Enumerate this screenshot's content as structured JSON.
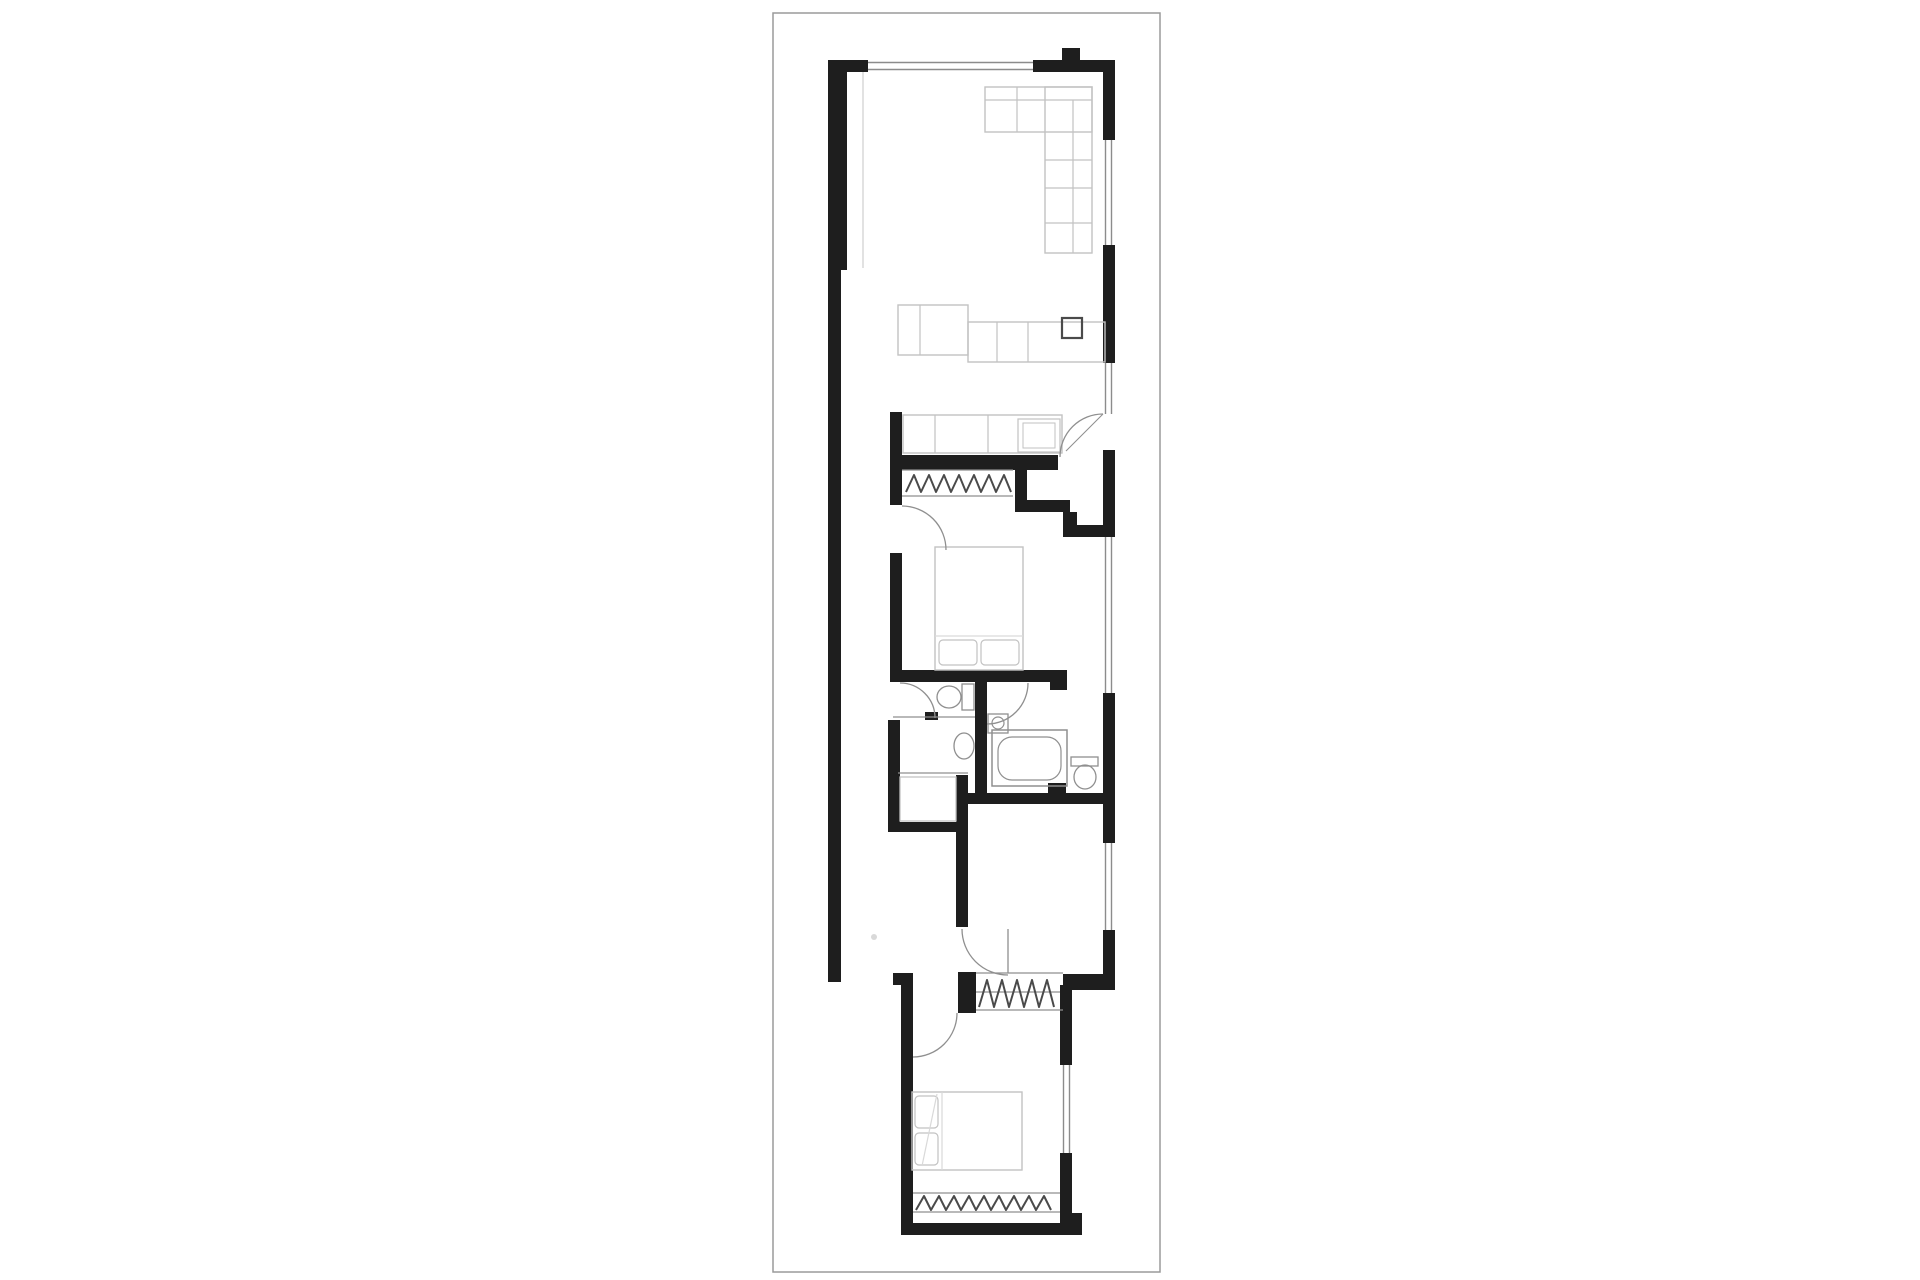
{
  "document": {
    "type": "architectural-floor-plan",
    "description": "Long narrow single-storey dwelling floor plan, black walls on white"
  },
  "canvas": {
    "width": 1920,
    "height": 1280,
    "background": "#ffffff"
  },
  "palette": {
    "wall": "#1e1e1e",
    "border": "#9a9a9a",
    "window": "#8c8c8c",
    "furniture": "#c2c2c2",
    "fixture": "#8f8f8f",
    "glyph": "#4a4a4a",
    "faint": "#d9d9d9"
  },
  "sheet_border": {
    "x": 773,
    "y": 13,
    "w": 387,
    "h": 1259
  },
  "elements": [
    {
      "n": "left-wall-upper",
      "t": "r",
      "x": 828,
      "y": 60,
      "w": 19,
      "h": 210,
      "f": "wall"
    },
    {
      "n": "left-wall-lower",
      "t": "r",
      "x": 828,
      "y": 268,
      "w": 13,
      "h": 714,
      "f": "wall"
    },
    {
      "n": "top-wall-left-stub",
      "t": "r",
      "x": 828,
      "y": 60,
      "w": 40,
      "h": 12,
      "f": "wall"
    },
    {
      "n": "top-wall-right",
      "t": "r",
      "x": 1033,
      "y": 60,
      "w": 82,
      "h": 12,
      "f": "wall"
    },
    {
      "n": "top-flue-stub",
      "t": "r",
      "x": 1062,
      "y": 48,
      "w": 18,
      "h": 13,
      "f": "wall"
    },
    {
      "n": "right-wall-seg1",
      "t": "r",
      "x": 1103,
      "y": 60,
      "w": 12,
      "h": 80,
      "f": "wall"
    },
    {
      "n": "right-wall-seg2",
      "t": "r",
      "x": 1103,
      "y": 245,
      "w": 12,
      "h": 118,
      "f": "wall"
    },
    {
      "n": "right-wall-seg3",
      "t": "r",
      "x": 1103,
      "y": 450,
      "w": 12,
      "h": 87,
      "f": "wall"
    },
    {
      "n": "right-wall-seg4",
      "t": "r",
      "x": 1103,
      "y": 693,
      "w": 12,
      "h": 150,
      "f": "wall"
    },
    {
      "n": "right-wall-seg5",
      "t": "r",
      "x": 1103,
      "y": 930,
      "w": 12,
      "h": 60,
      "f": "wall"
    },
    {
      "n": "laundry-left-wall",
      "t": "r",
      "x": 890,
      "y": 412,
      "w": 12,
      "h": 93,
      "f": "wall"
    },
    {
      "n": "bed1-left-wall",
      "t": "r",
      "x": 890,
      "y": 553,
      "w": 12,
      "h": 120,
      "f": "wall"
    },
    {
      "n": "laundry-bed1-wall",
      "t": "r",
      "x": 890,
      "y": 455,
      "w": 168,
      "h": 15,
      "f": "wall"
    },
    {
      "n": "vestibule-step-v1",
      "t": "r",
      "x": 1015,
      "y": 470,
      "w": 12,
      "h": 42,
      "f": "wall"
    },
    {
      "n": "vestibule-step-h1",
      "t": "r",
      "x": 1015,
      "y": 500,
      "w": 55,
      "h": 12,
      "f": "wall"
    },
    {
      "n": "vestibule-step-v2",
      "t": "r",
      "x": 1063,
      "y": 512,
      "w": 14,
      "h": 25,
      "f": "wall"
    },
    {
      "n": "vestibule-step-h2",
      "t": "r",
      "x": 1070,
      "y": 525,
      "w": 45,
      "h": 12,
      "f": "wall"
    },
    {
      "n": "bed1-bottom-wall",
      "t": "r",
      "x": 890,
      "y": 670,
      "w": 177,
      "h": 12,
      "f": "wall"
    },
    {
      "n": "bed1-bottom-stub",
      "t": "r",
      "x": 1050,
      "y": 682,
      "w": 17,
      "h": 8,
      "f": "wall"
    },
    {
      "n": "bath-center-wall",
      "t": "r",
      "x": 975,
      "y": 680,
      "w": 12,
      "h": 115,
      "f": "wall"
    },
    {
      "n": "wc-pier",
      "t": "r",
      "x": 925,
      "y": 712,
      "w": 13,
      "h": 8,
      "f": "wall"
    },
    {
      "n": "bath-left-wall",
      "t": "r",
      "x": 888,
      "y": 720,
      "w": 12,
      "h": 112,
      "f": "wall"
    },
    {
      "n": "store-bottom-wall",
      "t": "r",
      "x": 888,
      "y": 822,
      "w": 70,
      "h": 10,
      "f": "wall"
    },
    {
      "n": "rear-divider-wall",
      "t": "r",
      "x": 956,
      "y": 775,
      "w": 12,
      "h": 152,
      "f": "wall"
    },
    {
      "n": "bath-bottom-wall",
      "t": "r",
      "x": 958,
      "y": 793,
      "w": 152,
      "h": 11,
      "f": "wall"
    },
    {
      "n": "bath-bottom-pier",
      "t": "r",
      "x": 1048,
      "y": 783,
      "w": 18,
      "h": 10,
      "f": "wall"
    },
    {
      "n": "rear-robe-left-pier",
      "t": "r",
      "x": 958,
      "y": 972,
      "w": 18,
      "h": 41,
      "f": "wall"
    },
    {
      "n": "rear-right-bar",
      "t": "r",
      "x": 1063,
      "y": 974,
      "w": 52,
      "h": 16,
      "f": "wall"
    },
    {
      "n": "rear-bed-right-wall-top",
      "t": "r",
      "x": 1060,
      "y": 985,
      "w": 12,
      "h": 80,
      "f": "wall"
    },
    {
      "n": "rear-bed-right-wall-bottom",
      "t": "r",
      "x": 1060,
      "y": 1153,
      "w": 12,
      "h": 72,
      "f": "wall"
    },
    {
      "n": "rear-bed-bottom-wall",
      "t": "r",
      "x": 901,
      "y": 1223,
      "w": 181,
      "h": 12,
      "f": "wall"
    },
    {
      "n": "rear-bed-bottom-corner",
      "t": "r",
      "x": 1060,
      "y": 1213,
      "w": 22,
      "h": 12,
      "f": "wall"
    },
    {
      "n": "rear-bed-left-wall",
      "t": "r",
      "x": 901,
      "y": 985,
      "w": 12,
      "h": 250,
      "f": "wall"
    },
    {
      "n": "rear-bed-left-stub",
      "t": "r",
      "x": 893,
      "y": 973,
      "w": 20,
      "h": 12,
      "f": "wall"
    },
    {
      "n": "top-window-line1",
      "t": "l",
      "x1": 868,
      "y1": 62.5,
      "x2": 1033,
      "y2": 62.5,
      "s": "window",
      "sw": 1.4
    },
    {
      "n": "top-window-line2",
      "t": "l",
      "x1": 868,
      "y1": 69.5,
      "x2": 1033,
      "y2": 69.5,
      "s": "window",
      "sw": 1.4
    },
    {
      "n": "right-window1-line1",
      "t": "l",
      "x1": 1105.5,
      "y1": 140,
      "x2": 1105.5,
      "y2": 245,
      "s": "window",
      "sw": 1.4
    },
    {
      "n": "right-window1-line2",
      "t": "l",
      "x1": 1111.5,
      "y1": 140,
      "x2": 1111.5,
      "y2": 245,
      "s": "window",
      "sw": 1.4
    },
    {
      "n": "entry-sidelite-line1",
      "t": "l",
      "x1": 1105.5,
      "y1": 363,
      "x2": 1105.5,
      "y2": 414,
      "s": "window",
      "sw": 1.4
    },
    {
      "n": "entry-sidelite-line2",
      "t": "l",
      "x1": 1111.5,
      "y1": 363,
      "x2": 1111.5,
      "y2": 414,
      "s": "window",
      "sw": 1.4
    },
    {
      "n": "right-window2-line1",
      "t": "l",
      "x1": 1105.5,
      "y1": 537,
      "x2": 1105.5,
      "y2": 693,
      "s": "window",
      "sw": 1.4
    },
    {
      "n": "right-window2-line2",
      "t": "l",
      "x1": 1111.5,
      "y1": 537,
      "x2": 1111.5,
      "y2": 693,
      "s": "window",
      "sw": 1.4
    },
    {
      "n": "right-window3-line1",
      "t": "l",
      "x1": 1105.5,
      "y1": 843,
      "x2": 1105.5,
      "y2": 930,
      "s": "window",
      "sw": 1.4
    },
    {
      "n": "right-window3-line2",
      "t": "l",
      "x1": 1111.5,
      "y1": 843,
      "x2": 1111.5,
      "y2": 930,
      "s": "window",
      "sw": 1.4
    },
    {
      "n": "rear-window-line1",
      "t": "l",
      "x1": 1063.5,
      "y1": 1065,
      "x2": 1063.5,
      "y2": 1153,
      "s": "window",
      "sw": 1.4
    },
    {
      "n": "rear-window-line2",
      "t": "l",
      "x1": 1069.5,
      "y1": 1065,
      "x2": 1069.5,
      "y2": 1153,
      "s": "window",
      "sw": 1.4
    },
    {
      "n": "party-wall-face-line",
      "t": "l",
      "x1": 863,
      "y1": 72,
      "x2": 863,
      "y2": 268,
      "s": "faint",
      "sw": 1.5
    },
    {
      "n": "wc-divider-line",
      "t": "l",
      "x1": 893,
      "y1": 717,
      "x2": 975,
      "y2": 717,
      "s": "fixture",
      "sw": 1.2
    },
    {
      "n": "store-divider-line",
      "t": "l",
      "x1": 898,
      "y1": 773,
      "x2": 968,
      "y2": 773,
      "s": "fixture",
      "sw": 1.2
    },
    {
      "n": "ceiling-mark-dot",
      "t": "c",
      "cx": 874,
      "cy": 937,
      "r": 3,
      "f": "faint"
    },
    {
      "n": "sofa-top-arm",
      "t": "r",
      "x": 985,
      "y": 87,
      "w": 107,
      "h": 45,
      "s": "furniture",
      "sw": 1.4
    },
    {
      "n": "sofa-side-arm",
      "t": "r",
      "x": 1045,
      "y": 87,
      "w": 47,
      "h": 166,
      "s": "furniture",
      "sw": 1.4
    },
    {
      "n": "sofa-back-line",
      "t": "l",
      "x1": 985,
      "y1": 100,
      "x2": 1092,
      "y2": 100,
      "s": "furniture",
      "sw": 1.2
    },
    {
      "n": "sofa-seat-div",
      "t": "l",
      "x1": 1017,
      "y1": 87,
      "x2": 1017,
      "y2": 132,
      "s": "furniture",
      "sw": 1.2
    },
    {
      "n": "sofa-inner-line",
      "t": "l",
      "x1": 1073,
      "y1": 100,
      "x2": 1073,
      "y2": 253,
      "s": "furniture",
      "sw": 1.2
    },
    {
      "n": "sofa-cushion-div1",
      "t": "l",
      "x1": 1045,
      "y1": 160,
      "x2": 1092,
      "y2": 160,
      "s": "furniture",
      "sw": 1.2
    },
    {
      "n": "sofa-cushion-div2",
      "t": "l",
      "x1": 1045,
      "y1": 188,
      "x2": 1092,
      "y2": 188,
      "s": "furniture",
      "sw": 1.2
    },
    {
      "n": "sofa-cushion-div3",
      "t": "l",
      "x1": 1045,
      "y1": 223,
      "x2": 1092,
      "y2": 223,
      "s": "furniture",
      "sw": 1.2
    },
    {
      "n": "kitchen-island",
      "t": "r",
      "x": 898,
      "y": 305,
      "w": 70,
      "h": 50,
      "s": "furniture",
      "sw": 1.4
    },
    {
      "n": "kitchen-island-div",
      "t": "l",
      "x1": 920,
      "y1": 305,
      "x2": 920,
      "y2": 355,
      "s": "furniture",
      "sw": 1.2
    },
    {
      "n": "kitchen-counter",
      "t": "r",
      "x": 968,
      "y": 322,
      "w": 137,
      "h": 40,
      "s": "furniture",
      "sw": 1.4
    },
    {
      "n": "kitchen-counter-div1",
      "t": "l",
      "x1": 997,
      "y1": 322,
      "x2": 997,
      "y2": 362,
      "s": "furniture",
      "sw": 1.2
    },
    {
      "n": "kitchen-counter-div2",
      "t": "l",
      "x1": 1028,
      "y1": 322,
      "x2": 1028,
      "y2": 362,
      "s": "furniture",
      "sw": 1.2
    },
    {
      "n": "kitchen-sink",
      "t": "r",
      "x": 1062,
      "y": 318,
      "w": 20,
      "h": 20,
      "s": "glyph",
      "sw": 2.2
    },
    {
      "n": "laundry-bench",
      "t": "r",
      "x": 903,
      "y": 415,
      "w": 159,
      "h": 38,
      "s": "furniture",
      "sw": 1.4
    },
    {
      "n": "laundry-bench-div1",
      "t": "l",
      "x1": 935,
      "y1": 415,
      "x2": 935,
      "y2": 453,
      "s": "furniture",
      "sw": 1.2
    },
    {
      "n": "laundry-bench-div2",
      "t": "l",
      "x1": 988,
      "y1": 415,
      "x2": 988,
      "y2": 453,
      "s": "furniture",
      "sw": 1.2
    },
    {
      "n": "washing-machine",
      "t": "r",
      "x": 1018,
      "y": 419,
      "w": 42,
      "h": 33,
      "s": "furniture",
      "sw": 1.2
    },
    {
      "n": "washing-machine-inner",
      "t": "r",
      "x": 1023,
      "y": 423,
      "w": 32,
      "h": 25,
      "s": "furniture",
      "sw": 1
    },
    {
      "n": "robe1-top-line",
      "t": "l",
      "x1": 902,
      "y1": 470,
      "x2": 1013,
      "y2": 470,
      "s": "fixture",
      "sw": 1.2
    },
    {
      "n": "robe1-bottom-line",
      "t": "l",
      "x1": 902,
      "y1": 496,
      "x2": 1013,
      "y2": 496,
      "s": "fixture",
      "sw": 1.2
    },
    {
      "n": "robe1-zigzag",
      "t": "p",
      "d": "M906 492 L914 475 L921 492 L929 475 L936 492 L944 475 L951 492 L959 475 L966 492 L974 475 L981 492 L989 475 L996 492 L1004 475 L1011 492",
      "s": "glyph",
      "sw": 2
    },
    {
      "n": "bed1",
      "t": "r",
      "x": 935,
      "y": 547,
      "w": 88,
      "h": 123,
      "s": "furniture",
      "sw": 1.4
    },
    {
      "n": "bed1-pillow-left",
      "t": "r",
      "x": 939,
      "y": 640,
      "w": 38,
      "h": 25,
      "rx": 4,
      "s": "furniture",
      "sw": 1.2
    },
    {
      "n": "bed1-pillow-right",
      "t": "r",
      "x": 981,
      "y": 640,
      "w": 38,
      "h": 25,
      "rx": 4,
      "s": "furniture",
      "sw": 1.2
    },
    {
      "n": "bed1-sheet-line",
      "t": "l",
      "x1": 935,
      "y1": 636,
      "x2": 1023,
      "y2": 636,
      "s": "faint",
      "sw": 1.2
    },
    {
      "n": "wc1-cistern",
      "t": "r",
      "x": 962,
      "y": 684,
      "w": 12,
      "h": 26,
      "s": "fixture",
      "sw": 1.3
    },
    {
      "n": "wc1-bowl",
      "t": "e",
      "cx": 949,
      "cy": 697,
      "rx": 12,
      "ry": 11,
      "s": "fixture",
      "sw": 1.3
    },
    {
      "n": "ensuite-basin",
      "t": "e",
      "cx": 964,
      "cy": 746,
      "rx": 10,
      "ry": 13,
      "s": "fixture",
      "sw": 1.3
    },
    {
      "n": "bath2-basin",
      "t": "r",
      "x": 988,
      "y": 714,
      "w": 20,
      "h": 19,
      "s": "fixture",
      "sw": 1.3
    },
    {
      "n": "bath2-basin-bowl",
      "t": "c",
      "cx": 998,
      "cy": 723,
      "r": 6,
      "s": "fixture",
      "sw": 1.2
    },
    {
      "n": "store-unit",
      "t": "r",
      "x": 900,
      "y": 777,
      "w": 56,
      "h": 44,
      "s": "furniture",
      "sw": 1.3
    },
    {
      "n": "bathtub",
      "t": "r",
      "x": 992,
      "y": 730,
      "w": 75,
      "h": 56,
      "s": "fixture",
      "sw": 1.5
    },
    {
      "n": "bathtub-inner",
      "t": "r",
      "x": 998,
      "y": 737,
      "w": 63,
      "h": 43,
      "rx": 14,
      "s": "fixture",
      "sw": 1.2
    },
    {
      "n": "wc2-cistern",
      "t": "r",
      "x": 1071,
      "y": 757,
      "w": 27,
      "h": 9,
      "s": "fixture",
      "sw": 1.3
    },
    {
      "n": "wc2-bowl",
      "t": "e",
      "cx": 1085,
      "cy": 777,
      "rx": 11,
      "ry": 12,
      "s": "fixture",
      "sw": 1.3
    },
    {
      "n": "rear-robe-top-line",
      "t": "l",
      "x1": 976,
      "y1": 973,
      "x2": 1063,
      "y2": 973,
      "s": "fixture",
      "sw": 1.2
    },
    {
      "n": "rear-robe-bottom-line",
      "t": "l",
      "x1": 976,
      "y1": 1010,
      "x2": 1063,
      "y2": 1010,
      "s": "fixture",
      "sw": 1.2
    },
    {
      "n": "rear-robe-rail-line",
      "t": "l",
      "x1": 976,
      "y1": 992,
      "x2": 1060,
      "y2": 992,
      "s": "fixture",
      "sw": 1.2
    },
    {
      "n": "rear-robe-zigzag",
      "t": "p",
      "d": "M979 1007 L987 980 L994 1007 L1002 980 L1009 1007 L1017 980 L1024 1007 L1032 980 L1039 1007 L1047 980 L1054 1007",
      "s": "glyph",
      "sw": 2
    },
    {
      "n": "rear-bed",
      "t": "r",
      "x": 912,
      "y": 1092,
      "w": 110,
      "h": 78,
      "s": "furniture",
      "sw": 1.4
    },
    {
      "n": "rear-bed-pillow1",
      "t": "r",
      "x": 915,
      "y": 1096,
      "w": 23,
      "h": 32,
      "rx": 4,
      "s": "furniture",
      "sw": 1.2
    },
    {
      "n": "rear-bed-pillow2",
      "t": "r",
      "x": 915,
      "y": 1133,
      "w": 23,
      "h": 32,
      "rx": 4,
      "s": "furniture",
      "sw": 1.2
    },
    {
      "n": "rear-bed-fold-line",
      "t": "l",
      "x1": 937,
      "y1": 1094,
      "x2": 922,
      "y2": 1166,
      "s": "faint",
      "sw": 1.2
    },
    {
      "n": "rear-bed-sheet-line",
      "t": "l",
      "x1": 942,
      "y1": 1092,
      "x2": 942,
      "y2": 1170,
      "s": "faint",
      "sw": 1.2
    },
    {
      "n": "robe-rear-bed-top-line",
      "t": "l",
      "x1": 913,
      "y1": 1193,
      "x2": 1060,
      "y2": 1193,
      "s": "fixture",
      "sw": 1.2
    },
    {
      "n": "robe-rear-bed-bottom-line",
      "t": "l",
      "x1": 913,
      "y1": 1212,
      "x2": 1060,
      "y2": 1212,
      "s": "fixture",
      "sw": 1.2
    },
    {
      "n": "robe-rear-bed-zigzag",
      "t": "p",
      "d": "M916 1210 L924 1196 L931 1210 L939 1196 L946 1210 L954 1196 L961 1210 L969 1196 L976 1210 L984 1196 L991 1210 L999 1196 L1006 1210 L1014 1196 L1021 1210 L1029 1196 L1036 1210 L1044 1196 L1051 1210",
      "s": "glyph",
      "sw": 2
    },
    {
      "n": "entry-door-arc",
      "t": "p",
      "d": "M1103 414 A43 43 0 0 0 1060 457",
      "s": "fixture",
      "sw": 1.3
    },
    {
      "n": "entry-door-leaf",
      "t": "l",
      "x1": 1103,
      "y1": 414,
      "x2": 1066,
      "y2": 451,
      "s": "fixture",
      "sw": 1.1
    },
    {
      "n": "bed1-door-arc",
      "t": "p",
      "d": "M902 506 A44 44 0 0 1 946 550",
      "s": "fixture",
      "sw": 1.3
    },
    {
      "n": "wc1-door-arc",
      "t": "p",
      "d": "M900 683 A35 35 0 0 1 935 718",
      "s": "fixture",
      "sw": 1.3
    },
    {
      "n": "bath2-door-arc",
      "t": "p",
      "d": "M1028 683 A41 41 0 0 1 987 724",
      "s": "fixture",
      "sw": 1.3
    },
    {
      "n": "rear-room-door-arc",
      "t": "p",
      "d": "M962 929 A46 46 0 0 0 1008 975",
      "s": "fixture",
      "sw": 1.3
    },
    {
      "n": "rear-room-door-leaf",
      "t": "l",
      "x1": 1008,
      "y1": 929,
      "x2": 1008,
      "y2": 973,
      "s": "fixture",
      "sw": 1.3
    },
    {
      "n": "rear-bed-door-arc",
      "t": "p",
      "d": "M957 1013 A44 44 0 0 1 913 1057",
      "s": "fixture",
      "sw": 1.3
    }
  ]
}
